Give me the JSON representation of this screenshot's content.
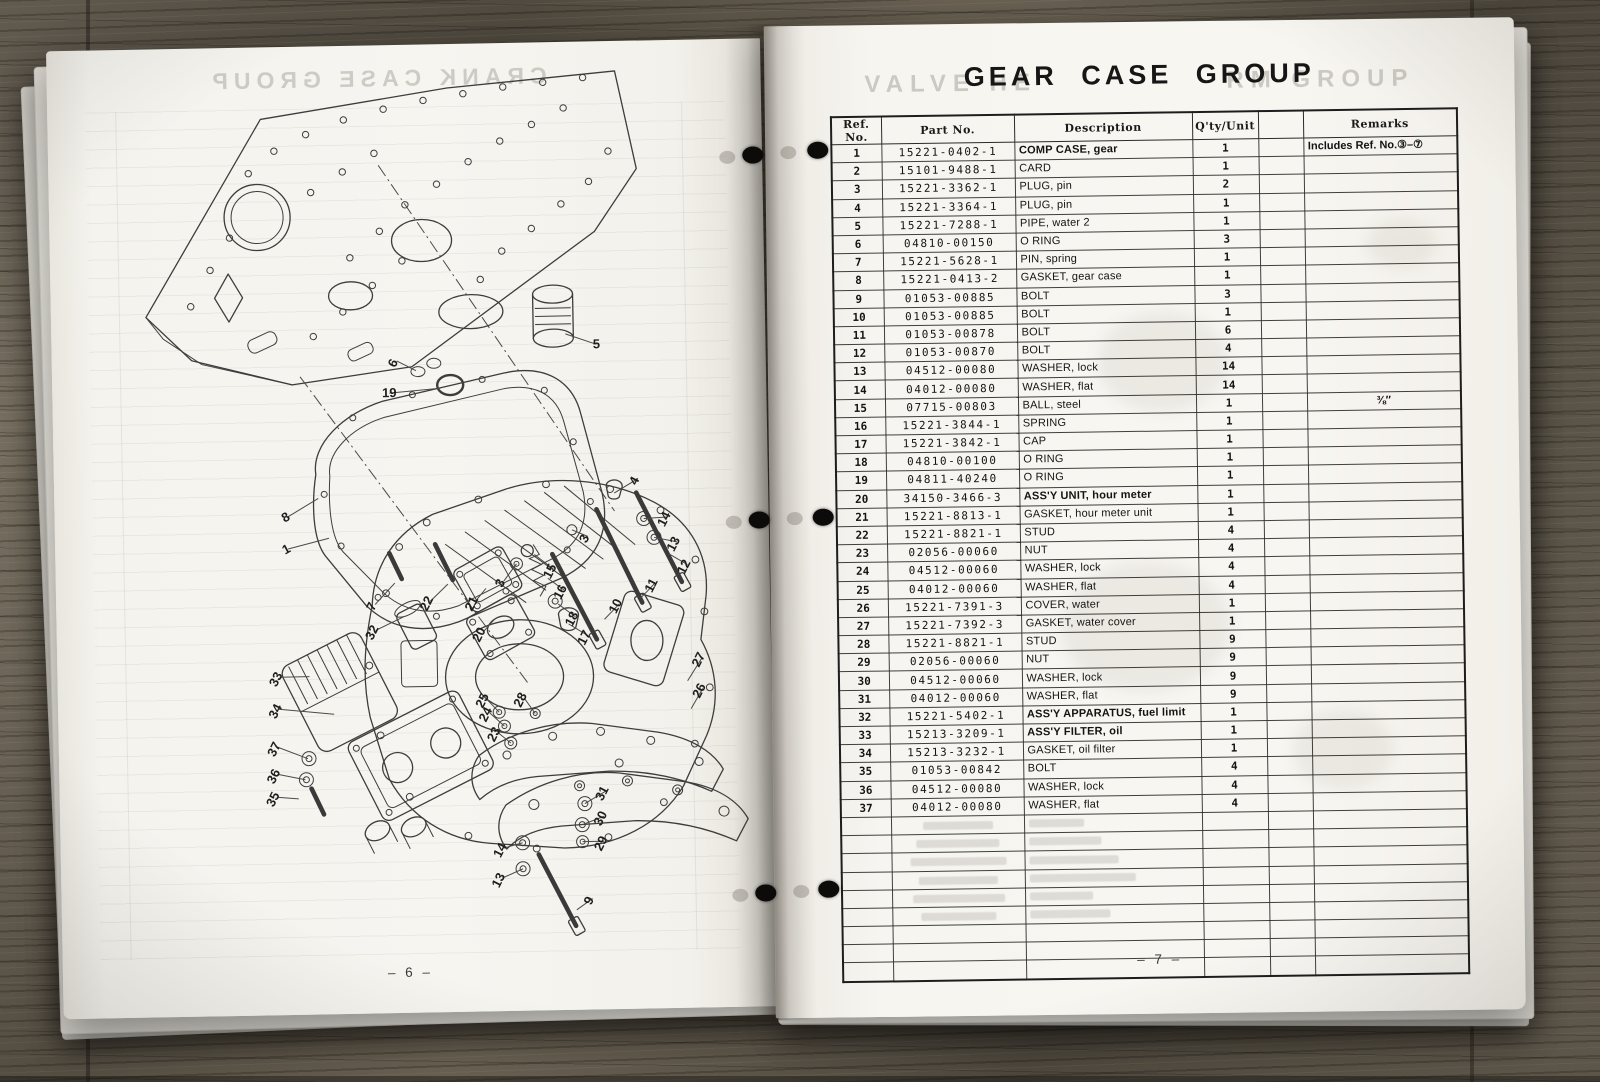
{
  "book": {
    "left_page": {
      "ghost_title": "CRANK CASE GROUP",
      "page_number": "– 6 –",
      "diagram": {
        "subject": "exploded view of gear case assembly",
        "callouts": [
          {
            "n": "19",
            "x": 337,
            "y": 352,
            "lx": 388,
            "ly": 344,
            "r": 0
          },
          {
            "n": "5",
            "x": 545,
            "y": 307,
            "lx": 514,
            "ly": 292,
            "r": 0
          },
          {
            "n": "6",
            "x": 345,
            "y": 320,
            "lx": 364,
            "ly": 326,
            "r": -62
          },
          {
            "n": "4",
            "x": 584,
            "y": 442,
            "lx": 560,
            "ly": 452,
            "r": -62
          },
          {
            "n": "14",
            "x": 613,
            "y": 481,
            "lx": 589,
            "ly": 478,
            "r": -62
          },
          {
            "n": "13",
            "x": 622,
            "y": 506,
            "lx": 599,
            "ly": 497,
            "r": -62
          },
          {
            "n": "12",
            "x": 632,
            "y": 529,
            "lx": 614,
            "ly": 514,
            "r": -62
          },
          {
            "n": "11",
            "x": 599,
            "y": 547,
            "lx": 584,
            "ly": 558,
            "r": -62
          },
          {
            "n": "10",
            "x": 563,
            "y": 567,
            "lx": 548,
            "ly": 578,
            "r": -62
          },
          {
            "n": "3",
            "x": 533,
            "y": 499,
            "lx": 517,
            "ly": 488,
            "r": -62
          },
          {
            "n": "15",
            "x": 498,
            "y": 531,
            "lx": 479,
            "ly": 512,
            "r": -62
          },
          {
            "n": "3",
            "x": 448,
            "y": 542,
            "lx": 461,
            "ly": 521,
            "r": -62
          },
          {
            "n": "16",
            "x": 508,
            "y": 552,
            "lx": 492,
            "ly": 536,
            "r": -62
          },
          {
            "n": "18",
            "x": 519,
            "y": 579,
            "lx": 502,
            "ly": 562,
            "r": -62
          },
          {
            "n": "17",
            "x": 531,
            "y": 598,
            "lx": 512,
            "ly": 582,
            "r": -62
          },
          {
            "n": "8",
            "x": 233,
            "y": 474,
            "lx": 264,
            "ly": 452,
            "r": -28
          },
          {
            "n": "1",
            "x": 233,
            "y": 506,
            "lx": 274,
            "ly": 492,
            "r": -28
          },
          {
            "n": "7",
            "x": 319,
            "y": 563,
            "lx": 339,
            "ly": 538,
            "r": -62
          },
          {
            "n": "32",
            "x": 319,
            "y": 589,
            "lx": 347,
            "ly": 572,
            "r": -62
          },
          {
            "n": "22",
            "x": 374,
            "y": 561,
            "lx": 392,
            "ly": 540,
            "r": -62
          },
          {
            "n": "21",
            "x": 419,
            "y": 562,
            "lx": 430,
            "ly": 545,
            "r": -62
          },
          {
            "n": "20",
            "x": 426,
            "y": 593,
            "lx": 438,
            "ly": 576,
            "r": -62
          },
          {
            "n": "33",
            "x": 222,
            "y": 634,
            "lx": 252,
            "ly": 630,
            "r": -62
          },
          {
            "n": "34",
            "x": 221,
            "y": 666,
            "lx": 276,
            "ly": 668,
            "r": -62
          },
          {
            "n": "25",
            "x": 428,
            "y": 659,
            "lx": 441,
            "ly": 669,
            "r": -62
          },
          {
            "n": "24",
            "x": 431,
            "y": 673,
            "lx": 446,
            "ly": 683,
            "r": -62
          },
          {
            "n": "23",
            "x": 439,
            "y": 693,
            "lx": 452,
            "ly": 700,
            "r": -62
          },
          {
            "n": "28",
            "x": 466,
            "y": 659,
            "lx": 477,
            "ly": 671,
            "r": -62
          },
          {
            "n": "27",
            "x": 645,
            "y": 622,
            "lx": 630,
            "ly": 641,
            "r": -62
          },
          {
            "n": "26",
            "x": 645,
            "y": 653,
            "lx": 633,
            "ly": 669,
            "r": -62
          },
          {
            "n": "37",
            "x": 219,
            "y": 704,
            "lx": 249,
            "ly": 712,
            "r": -62
          },
          {
            "n": "36",
            "x": 218,
            "y": 731,
            "lx": 246,
            "ly": 733,
            "r": -62
          },
          {
            "n": "35",
            "x": 217,
            "y": 754,
            "lx": 239,
            "ly": 752,
            "r": -62
          },
          {
            "n": "31",
            "x": 546,
            "y": 754,
            "lx": 525,
            "ly": 762,
            "r": -62
          },
          {
            "n": "30",
            "x": 544,
            "y": 779,
            "lx": 522,
            "ly": 783,
            "r": -62
          },
          {
            "n": "29",
            "x": 544,
            "y": 804,
            "lx": 522,
            "ly": 800,
            "r": -62
          },
          {
            "n": "14",
            "x": 443,
            "y": 809,
            "lx": 462,
            "ly": 800,
            "r": -62
          },
          {
            "n": "13",
            "x": 441,
            "y": 839,
            "lx": 462,
            "ly": 826,
            "r": -62
          },
          {
            "n": "9",
            "x": 531,
            "y": 861,
            "lx": 515,
            "ly": 868,
            "r": -62
          }
        ]
      }
    },
    "right_page": {
      "title": "GEAR CASE GROUP",
      "ghost_title_left": "VALVE HE",
      "ghost_title_right": "RM GROUP",
      "page_number": "– 7 –",
      "table": {
        "headers": [
          "Ref. No.",
          "Part No.",
          "Description",
          "Q'ty/Unit",
          "",
          "Remarks"
        ],
        "rows": [
          {
            "ref": "1",
            "part": "15221-0402-1",
            "desc": "COMP CASE, gear",
            "qty": "1",
            "remarks": "Includes Ref. No.③–⑦",
            "bold": true
          },
          {
            "ref": "2",
            "part": "15101-9488-1",
            "desc": "CARD",
            "qty": "1",
            "remarks": ""
          },
          {
            "ref": "3",
            "part": "15221-3362-1",
            "desc": "PLUG, pin",
            "qty": "2",
            "remarks": ""
          },
          {
            "ref": "4",
            "part": "15221-3364-1",
            "desc": "PLUG, pin",
            "qty": "1",
            "remarks": ""
          },
          {
            "ref": "5",
            "part": "15221-7288-1",
            "desc": "PIPE, water 2",
            "qty": "1",
            "remarks": ""
          },
          {
            "ref": "6",
            "part": "04810-00150",
            "desc": "O RING",
            "qty": "3",
            "remarks": ""
          },
          {
            "ref": "7",
            "part": "15221-5628-1",
            "desc": "PIN, spring",
            "qty": "1",
            "remarks": ""
          },
          {
            "ref": "8",
            "part": "15221-0413-2",
            "desc": "GASKET, gear case",
            "qty": "1",
            "remarks": ""
          },
          {
            "ref": "9",
            "part": "01053-00885",
            "desc": "BOLT",
            "qty": "3",
            "remarks": ""
          },
          {
            "ref": "10",
            "part": "01053-00885",
            "desc": "BOLT",
            "qty": "1",
            "remarks": ""
          },
          {
            "ref": "11",
            "part": "01053-00878",
            "desc": "BOLT",
            "qty": "6",
            "remarks": ""
          },
          {
            "ref": "12",
            "part": "01053-00870",
            "desc": "BOLT",
            "qty": "4",
            "remarks": ""
          },
          {
            "ref": "13",
            "part": "04512-00080",
            "desc": "WASHER, lock",
            "qty": "14",
            "remarks": ""
          },
          {
            "ref": "14",
            "part": "04012-00080",
            "desc": "WASHER, flat",
            "qty": "14",
            "remarks": ""
          },
          {
            "ref": "15",
            "part": "07715-00803",
            "desc": "BALL, steel",
            "qty": "1",
            "remarks": "⅜″"
          },
          {
            "ref": "16",
            "part": "15221-3844-1",
            "desc": "SPRING",
            "qty": "1",
            "remarks": ""
          },
          {
            "ref": "17",
            "part": "15221-3842-1",
            "desc": "CAP",
            "qty": "1",
            "remarks": ""
          },
          {
            "ref": "18",
            "part": "04810-00100",
            "desc": "O RING",
            "qty": "1",
            "remarks": ""
          },
          {
            "ref": "19",
            "part": "04811-40240",
            "desc": "O RING",
            "qty": "1",
            "remarks": ""
          },
          {
            "ref": "20",
            "part": "34150-3466-3",
            "desc": "ASS'Y UNIT, hour meter",
            "qty": "1",
            "remarks": "",
            "bold": true
          },
          {
            "ref": "21",
            "part": "15221-8813-1",
            "desc": "GASKET, hour meter unit",
            "qty": "1",
            "remarks": ""
          },
          {
            "ref": "22",
            "part": "15221-8821-1",
            "desc": "STUD",
            "qty": "4",
            "remarks": ""
          },
          {
            "ref": "23",
            "part": "02056-00060",
            "desc": "NUT",
            "qty": "4",
            "remarks": ""
          },
          {
            "ref": "24",
            "part": "04512-00060",
            "desc": "WASHER, lock",
            "qty": "4",
            "remarks": ""
          },
          {
            "ref": "25",
            "part": "04012-00060",
            "desc": "WASHER, flat",
            "qty": "4",
            "remarks": ""
          },
          {
            "ref": "26",
            "part": "15221-7391-3",
            "desc": "COVER, water",
            "qty": "1",
            "remarks": ""
          },
          {
            "ref": "27",
            "part": "15221-7392-3",
            "desc": "GASKET, water cover",
            "qty": "1",
            "remarks": ""
          },
          {
            "ref": "28",
            "part": "15221-8821-1",
            "desc": "STUD",
            "qty": "9",
            "remarks": ""
          },
          {
            "ref": "29",
            "part": "02056-00060",
            "desc": "NUT",
            "qty": "9",
            "remarks": ""
          },
          {
            "ref": "30",
            "part": "04512-00060",
            "desc": "WASHER, lock",
            "qty": "9",
            "remarks": ""
          },
          {
            "ref": "31",
            "part": "04012-00060",
            "desc": "WASHER, flat",
            "qty": "9",
            "remarks": ""
          },
          {
            "ref": "32",
            "part": "15221-5402-1",
            "desc": "ASS'Y APPARATUS, fuel limit",
            "qty": "1",
            "remarks": "",
            "bold": true
          },
          {
            "ref": "33",
            "part": "15213-3209-1",
            "desc": "ASS'Y FILTER, oil",
            "qty": "1",
            "remarks": "",
            "bold": true
          },
          {
            "ref": "34",
            "part": "15213-3232-1",
            "desc": "GASKET, oil filter",
            "qty": "1",
            "remarks": ""
          },
          {
            "ref": "35",
            "part": "01053-00842",
            "desc": "BOLT",
            "qty": "4",
            "remarks": ""
          },
          {
            "ref": "36",
            "part": "04512-00080",
            "desc": "WASHER, lock",
            "qty": "4",
            "remarks": ""
          },
          {
            "ref": "37",
            "part": "04012-00080",
            "desc": "WASHER, flat",
            "qty": "4",
            "remarks": ""
          }
        ],
        "empty_row_count": 9
      }
    }
  }
}
